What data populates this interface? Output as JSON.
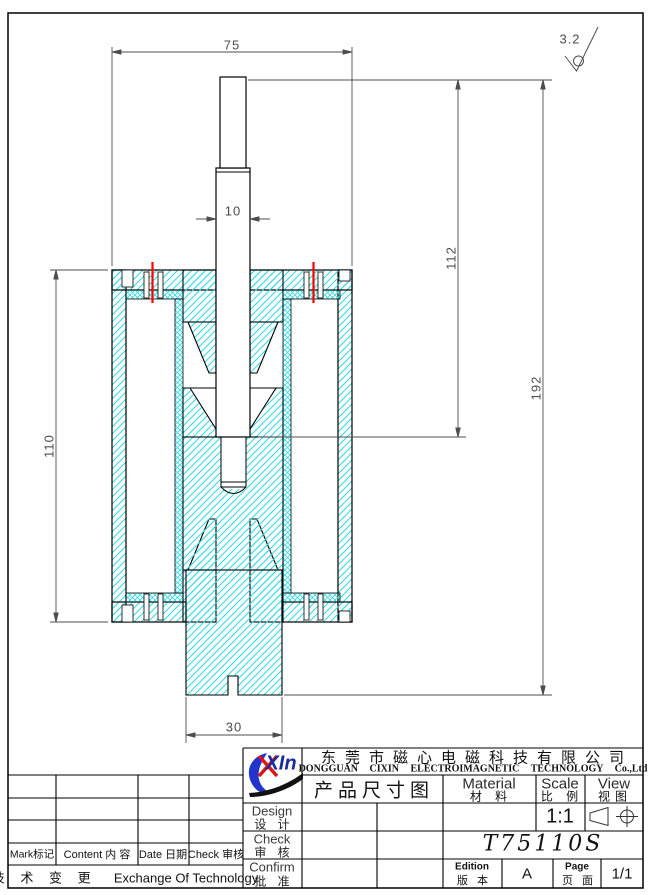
{
  "drawing": {
    "dim_top_width": "75",
    "dim_shaft_width": "10",
    "dim_body_height": "110",
    "dim_stroke_depth": "112",
    "dim_total_height": "192",
    "dim_base_width": "30",
    "surface_roughness": "3.2"
  },
  "title_block": {
    "logo_text": "XIn",
    "company_cn": "东莞市磁心电磁科技有限公司",
    "company_en": "DONGGUAN CIXIN ELECTROIMAGNETIC TECHNOLOGY Co.,Ltd",
    "doc_title": "产品尺寸图",
    "material_en": "Material",
    "material_cn": "材 料",
    "scale_en": "Scale",
    "scale_cn": "比 例",
    "scale_value": "1:1",
    "view_en": "View",
    "view_cn": "视图",
    "design_en": "Design",
    "design_cn": "设 计",
    "check_en": "Check",
    "check_cn": "审 核",
    "confirm_en": "Confirm",
    "confirm_cn": "批 准",
    "part_number": "T75110S",
    "edition_en": "Edition",
    "edition_cn": "版 本",
    "edition_value": "A",
    "page_en": "Page",
    "page_cn": "页 面",
    "page_value": "1/1"
  },
  "revision_table": {
    "col_mark": "Mark标记",
    "col_content": "Content 内 容",
    "col_date": "Date 日期",
    "col_check": "Check 审核",
    "footer_cn": "技 术 变 更",
    "footer_en": "Exchange Of Technology"
  },
  "colors": {
    "hatch": "#36dbe6",
    "red_mark": "#ff0000",
    "line": "#000000",
    "dim_text": "#4d4d4d"
  }
}
